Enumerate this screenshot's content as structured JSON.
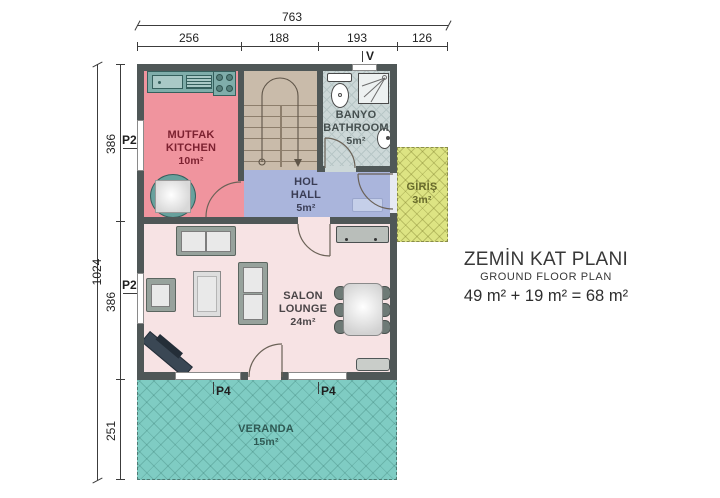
{
  "plan": {
    "rooms": {
      "kitchen": {
        "name_tr": "MUTFAK",
        "name_en": "KITCHEN",
        "area": "10m²"
      },
      "bathroom": {
        "name_tr": "BANYO",
        "name_en": "BATHROOM",
        "area": "5m²"
      },
      "hall": {
        "name_tr": "HOL",
        "name_en": "HALL",
        "area": "5m²"
      },
      "entry": {
        "name_tr": "GİRİŞ",
        "area": "3m²"
      },
      "lounge": {
        "name_tr": "SALON",
        "name_en": "LOUNGE",
        "area": "24m²"
      },
      "veranda": {
        "name_tr": "VERANDA",
        "area": "15m²"
      }
    },
    "door_labels": {
      "left_upper": "P2",
      "left_lower": "P2",
      "veranda_left": "P4",
      "veranda_right": "P4",
      "vent": "V"
    },
    "dimensions": {
      "top_total": "763",
      "top_segments": [
        "256",
        "188",
        "193",
        "126"
      ],
      "left_total": "1024",
      "left_segments": [
        "386",
        "386",
        "251"
      ]
    },
    "colors": {
      "wall": "#4f5757",
      "kitchen": "#f0949e",
      "stairs": "#c9bbaa",
      "bathroom": "#cdd8d8",
      "hall": "#aab5dc",
      "lounge": "#f7e3e4",
      "veranda": "#7fccc3",
      "entry": "#dde483",
      "counter": "#7fadaa",
      "kitchen_text": "#7c2130",
      "hall_text": "#3a3d55",
      "bath_text": "#454f4f",
      "lounge_text": "#4a4547",
      "veranda_text": "#2f5a54",
      "entry_text": "#686b2c"
    }
  },
  "title_block": {
    "title_tr": "ZEMİN KAT PLANI",
    "title_en": "GROUND FLOOR PLAN",
    "area_equation": "49 m² + 19 m² = 68 m²"
  }
}
